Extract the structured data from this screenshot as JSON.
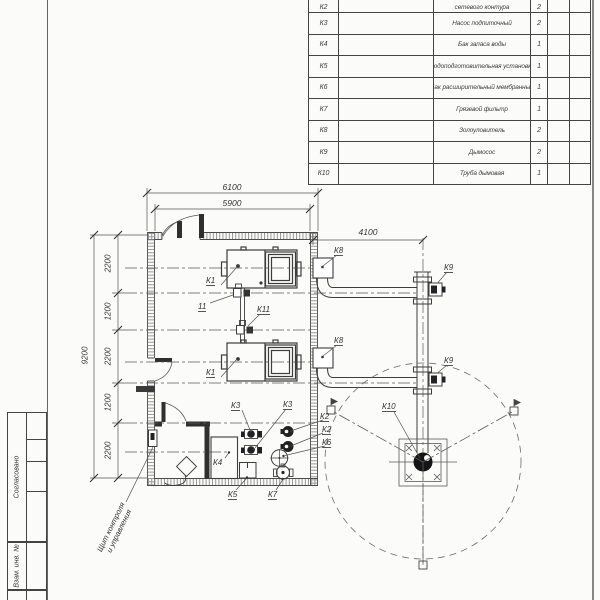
{
  "doc_type": "boiler-house layout drawing",
  "table": {
    "rows": [
      {
        "pos": "К2",
        "name": "сетевого контура",
        "qty": "2"
      },
      {
        "pos": "К3",
        "name": "Насос подпиточный",
        "qty": "2"
      },
      {
        "pos": "К4",
        "name": "Бак запаса воды",
        "qty": "1"
      },
      {
        "pos": "К5",
        "name": "Водоподготовительная установка",
        "qty": "1"
      },
      {
        "pos": "К6",
        "name": "Бак расширительный мембранный",
        "qty": "1"
      },
      {
        "pos": "К7",
        "name": "Грязевой фильтр",
        "qty": "1"
      },
      {
        "pos": "К8",
        "name": "Золоуловитель",
        "qty": "2"
      },
      {
        "pos": "К9",
        "name": "Дымосос",
        "qty": "2"
      },
      {
        "pos": "К10",
        "name": "Труба дымовая",
        "qty": "1"
      }
    ]
  },
  "dimensions": {
    "width_outer": "6100",
    "width_inner": "5900",
    "right_span": "4100",
    "overall_height": "9200",
    "segs": [
      "2200",
      "1200",
      "2200",
      "1200",
      "2200"
    ]
  },
  "plan": {
    "labels": {
      "k1a": "К1",
      "k1b": "К1",
      "v11": "11",
      "k11": "К11",
      "k3a": "К3",
      "k3b": "К3",
      "k2a": "К2",
      "k2b": "К2",
      "k6": "К6",
      "k4": "К4",
      "k5": "К5",
      "k7": "К7",
      "k8a": "К8",
      "k8b": "К8",
      "k9a": "К9",
      "k9b": "К9",
      "k10": "К10"
    },
    "note_line1": "Щит контроля",
    "note_line2": "и управления"
  },
  "sidebar": {
    "agreed": "Согласовано",
    "replace_inv": "Взам. инв. №"
  },
  "colors": {
    "line": "#474747",
    "wall_stipple": "#9a9a9a",
    "equip_fill": "#222222"
  }
}
